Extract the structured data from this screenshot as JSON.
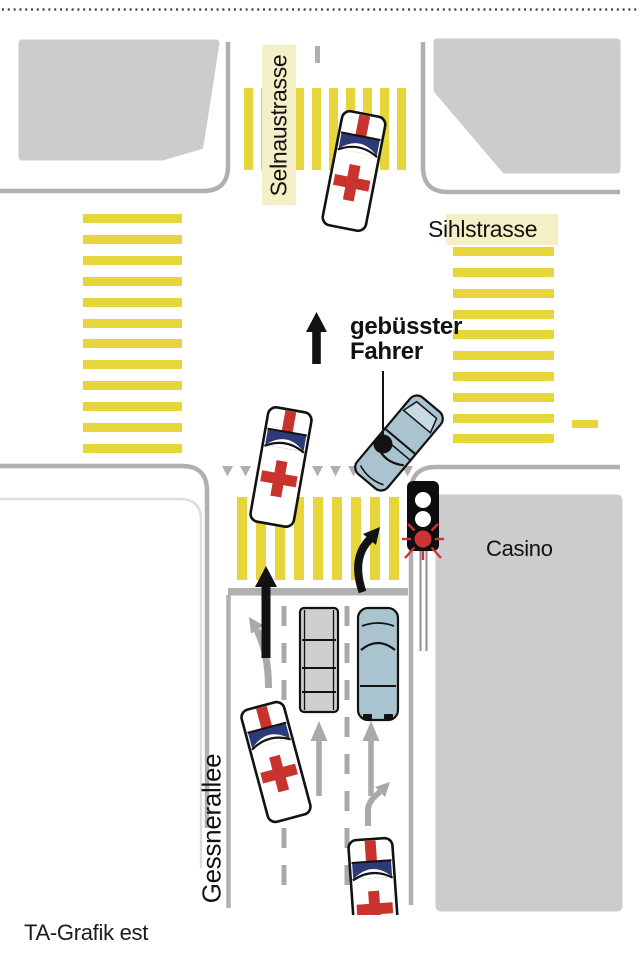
{
  "diagram": {
    "streets": {
      "top": "Selnaustrasse",
      "cross": "Sihlstrasse",
      "bottom": "Gessnerallee"
    },
    "building_label": "Casino",
    "annotation": {
      "line1": "gebüsster",
      "line2": "Fahrer"
    },
    "credit": "TA-Grafik est",
    "icon_legend": {
      "ambulance": "ambulance-top-view",
      "fined_driver_car": "blue-car-top-view",
      "traffic_light": "traffic-light-red",
      "crosswalk": "yellow-zebra-stripes"
    }
  },
  "colors": {
    "crosswalk_yellow": "#e7d63b",
    "label_highlight": "#f5efc8",
    "building_gray": "#cccccc",
    "curb_gray": "#b0b0b0",
    "lane_gray": "#a9a9a9",
    "ambulance_red": "#c8332e",
    "windshield_blue": "#2d3a78",
    "car_blue": "#a9c3cf",
    "signal_red": "#cf3434",
    "ink": "#121212"
  }
}
